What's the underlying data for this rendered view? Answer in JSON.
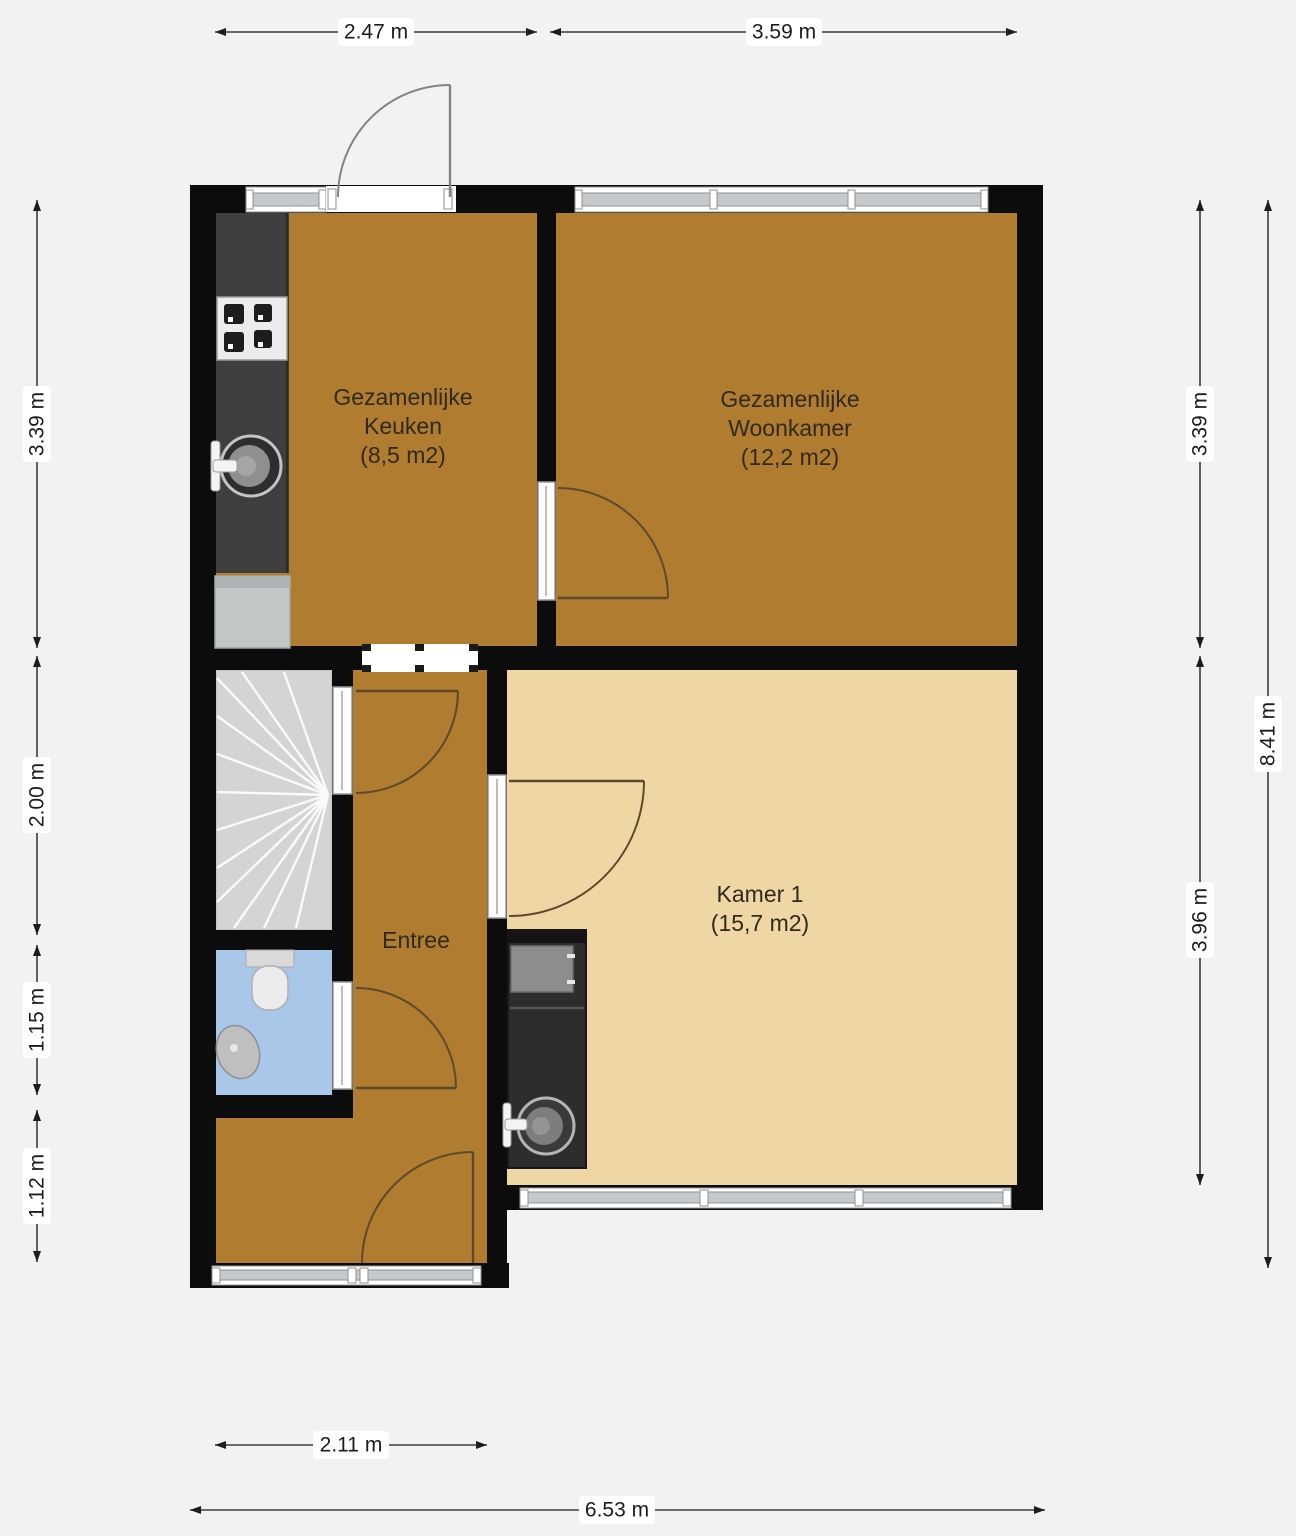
{
  "plan": {
    "rooms": [
      {
        "name": "keuken",
        "lines": [
          "Gezamenlijke",
          "Keuken",
          "(8,5 m2)"
        ]
      },
      {
        "name": "woonkamer",
        "lines": [
          "Gezamenlijke",
          "Woonkamer",
          "(12,2 m2)"
        ]
      },
      {
        "name": "entree",
        "lines": [
          "Entree"
        ]
      },
      {
        "name": "kamer1",
        "lines": [
          "Kamer 1",
          "(15,7 m2)"
        ]
      }
    ],
    "dimensions": {
      "top": [
        {
          "label": "2.47 m"
        },
        {
          "label": "3.59 m"
        }
      ],
      "left": [
        {
          "label": "3.39 m"
        },
        {
          "label": "2.00 m"
        },
        {
          "label": "1.15 m"
        },
        {
          "label": "1.12 m"
        }
      ],
      "right": [
        {
          "label": "3.39 m"
        },
        {
          "label": "3.96 m"
        },
        {
          "label": "8.41 m"
        }
      ],
      "bottom": [
        {
          "label": "2.11 m"
        },
        {
          "label": "6.53 m"
        }
      ]
    },
    "colors": {
      "floor_shared": "#b07c2f",
      "floor_room": "#efd7a5",
      "floor_wc": "#a9c7e8",
      "stairs": "#d4d4d4",
      "wall": "#0c0c0c",
      "window_glass": "#c6c9cb",
      "counter": "#3e3e3e",
      "kitchenette": "#2d2d2d",
      "background": "#f2f2f2"
    },
    "fixtures": [
      {
        "icon": "stove-icon"
      },
      {
        "icon": "kitchen-sink-icon"
      },
      {
        "icon": "kitchen-appliance-icon"
      },
      {
        "icon": "toilet-icon"
      },
      {
        "icon": "washbasin-icon"
      },
      {
        "icon": "kitchenette-sink-icon"
      },
      {
        "icon": "stairs-icon"
      }
    ]
  }
}
